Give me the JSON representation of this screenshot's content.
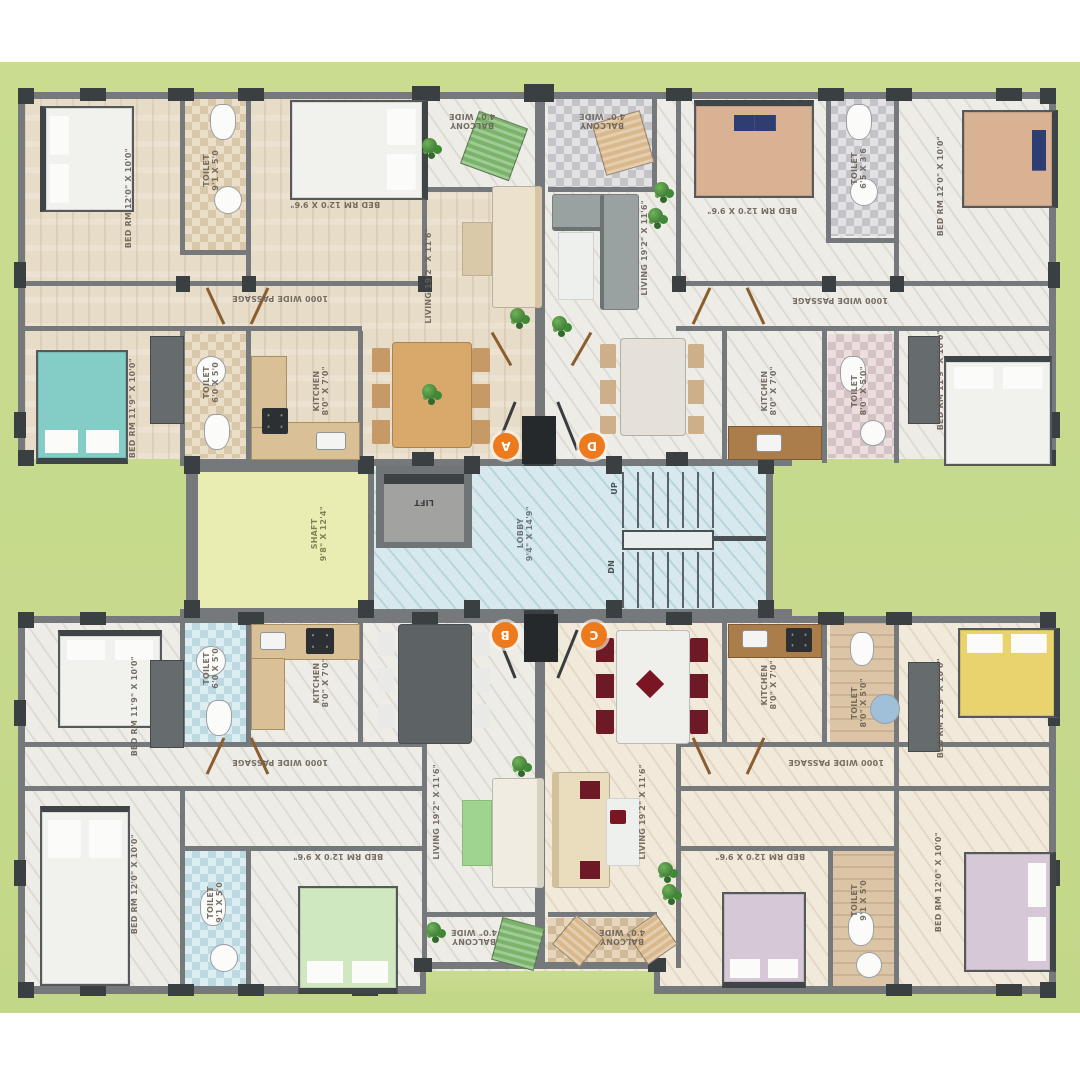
{
  "plan": {
    "type": "residential-apartment-floor-plan",
    "units": [
      {
        "id": "A",
        "position": "top-left"
      },
      {
        "id": "B",
        "position": "bottom-left"
      },
      {
        "id": "C",
        "position": "bottom-right"
      },
      {
        "id": "D",
        "position": "top-right"
      }
    ],
    "rooms": {
      "bed_12_10": "BED RM 12'0\" X 10'0\"",
      "bed_12_96": "BED RM 12'0 X 9'6\"",
      "bed_119_10": "BED RM 11'9\" X 10'0\"",
      "toilet_91_50": "TOILET\n9'1 X 5'0",
      "toilet_60_50": "TOILET\n6'0 X 5'0",
      "toilet_65_36": "TOILET\n6'5 X 3'6",
      "toilet_80_50": "TOILET\n8'0\" X 5'0\"",
      "kitchen_80_70": "KITCHEN\n8'0\" X 7'0\"",
      "living_192_116": "LIVING 19'2\" X 11'6\"",
      "balcony_40": "BALCONY\n4'0\" WIDE",
      "passage_1000": "1000 WIDE PASSAGE",
      "shaft": "SHAFT\n9'8\" X 12'4\"",
      "lobby": "LOBBY\n9'4\" X 14'9\"",
      "lift": "LIFT",
      "up": "UP",
      "dn": "DN"
    },
    "markers": {
      "flat_a": "A",
      "flat_b": "B",
      "flat_c": "C",
      "flat_d": "D"
    },
    "colors": {
      "site_green": "#c6d98e",
      "wall_gray": "#75797b",
      "column_dark": "#3a3f41",
      "shaft_yellow": "#e9edb2",
      "core_blue_marble": "#d7e9ec",
      "marker_orange": "#ee7a1e",
      "wood_floor": "#e7dcc8",
      "white_marble_floor": "#edece7",
      "warm_marble_floor": "#f1e9da",
      "bed_teal": "#84ccc6",
      "bed_tan": "#d9b294",
      "bed_green": "#cfe8c0",
      "bed_yellow": "#e8d36e",
      "bed_lavender": "#d6c8d6",
      "sofa_cream": "#eaddbe",
      "sofa_gray": "#9aa1a1",
      "chair_maroon": "#6e1a26"
    }
  }
}
